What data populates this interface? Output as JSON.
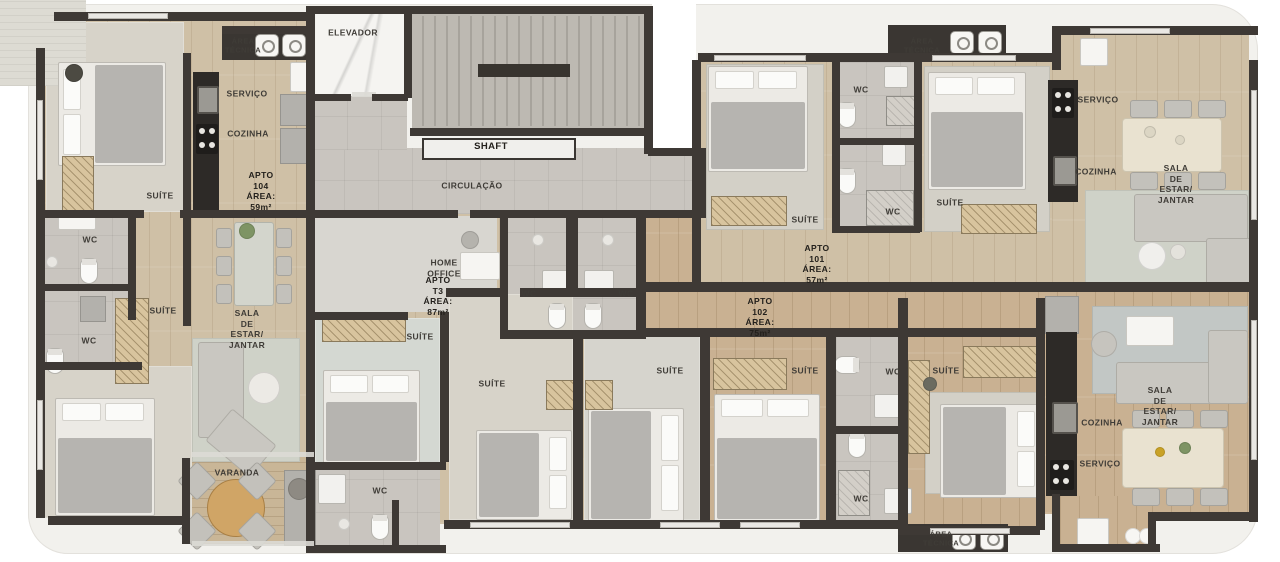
{
  "plan": {
    "title_visible": false,
    "building_common_areas": [
      "ELEVADOR",
      "SHAFT",
      "CIRCULAÇÃO",
      "ÁREA TÉCNICA"
    ],
    "apartments": [
      {
        "name": "APTO 104",
        "area": "ÁREA: 59m²",
        "rooms": [
          "SUÍTE",
          "WC",
          "SUÍTE",
          "COZINHA",
          "SERVIÇO",
          "SALA DE ESTAR/ JANTAR",
          "VARANDA",
          "WC"
        ]
      },
      {
        "name": "APTO T3",
        "area": "ÁREA: 87m²",
        "rooms": [
          "HOME OFFICE",
          "SUÍTE",
          "SUÍTE",
          "WC",
          "WC",
          "WC"
        ]
      },
      {
        "name": "APTO 101",
        "area": "ÁREA: 57m²",
        "rooms": [
          "SUÍTE",
          "SUÍTE",
          "WC",
          "WC",
          "COZINHA",
          "SERVIÇO",
          "SALA DE ESTAR/ JANTAR"
        ]
      },
      {
        "name": "APTO 102",
        "area": "ÁREA: 75m²",
        "rooms": [
          "SUÍTE",
          "SUÍTE",
          "SUÍTE",
          "WC",
          "WC",
          "COZINHA",
          "SERVIÇO",
          "SALA DE ESTAR/ JANTAR"
        ]
      }
    ]
  },
  "labels": [
    {
      "t": "ÁREA\nTÉCNICA",
      "x": 243,
      "y": 46,
      "s": 7.5,
      "b": 0
    },
    {
      "t": "ELEVADOR",
      "x": 353,
      "y": 33,
      "s": 8.5,
      "b": 0
    },
    {
      "t": "SERVIÇO",
      "x": 247,
      "y": 94,
      "s": 8.5,
      "b": 0
    },
    {
      "t": "COZINHA",
      "x": 248,
      "y": 134,
      "s": 8.5,
      "b": 0
    },
    {
      "t": "APTO 104\nÁREA: 59m²",
      "x": 261,
      "y": 191,
      "s": 8.5,
      "b": 1
    },
    {
      "t": "SUÍTE",
      "x": 160,
      "y": 196,
      "s": 8.5,
      "b": 0
    },
    {
      "t": "WC",
      "x": 90,
      "y": 240,
      "s": 8.5,
      "b": 0
    },
    {
      "t": "SUÍTE",
      "x": 163,
      "y": 311,
      "s": 8.5,
      "b": 0
    },
    {
      "t": "SALA DE ESTAR/\nJANTAR",
      "x": 247,
      "y": 329,
      "s": 8.5,
      "b": 0
    },
    {
      "t": "WC",
      "x": 89,
      "y": 341,
      "s": 8.5,
      "b": 0
    },
    {
      "t": "VARANDA",
      "x": 237,
      "y": 473,
      "s": 8.5,
      "b": 0
    },
    {
      "t": "SHAFT",
      "x": 491,
      "y": 147,
      "s": 9.5,
      "b": 1
    },
    {
      "t": "CIRCULAÇÃO",
      "x": 472,
      "y": 186,
      "s": 8.5,
      "b": 0
    },
    {
      "t": "HOME\nOFFICE",
      "x": 444,
      "y": 268,
      "s": 8.5,
      "b": 0
    },
    {
      "t": "APTO T3\nÁREA: 87m²",
      "x": 438,
      "y": 296,
      "s": 8.5,
      "b": 1
    },
    {
      "t": "SUÍTE",
      "x": 420,
      "y": 337,
      "s": 8.5,
      "b": 0
    },
    {
      "t": "WC",
      "x": 529,
      "y": 294,
      "s": 8.5,
      "b": 0
    },
    {
      "t": "WC",
      "x": 626,
      "y": 294,
      "s": 8.5,
      "b": 0
    },
    {
      "t": "SUÍTE",
      "x": 492,
      "y": 384,
      "s": 8.5,
      "b": 0
    },
    {
      "t": "WC",
      "x": 380,
      "y": 491,
      "s": 8.5,
      "b": 0
    },
    {
      "t": "ÁREA\nTÉCNICA",
      "x": 922,
      "y": 46,
      "s": 7.5,
      "b": 0
    },
    {
      "t": "WC",
      "x": 861,
      "y": 90,
      "s": 8.5,
      "b": 0
    },
    {
      "t": "SUÍTE",
      "x": 805,
      "y": 220,
      "s": 8.5,
      "b": 0
    },
    {
      "t": "WC",
      "x": 893,
      "y": 212,
      "s": 8.5,
      "b": 0
    },
    {
      "t": "SUÍTE",
      "x": 950,
      "y": 203,
      "s": 8.5,
      "b": 0
    },
    {
      "t": "APTO 101\nÁREA: 57m²",
      "x": 817,
      "y": 264,
      "s": 8.5,
      "b": 1
    },
    {
      "t": "SERVIÇO",
      "x": 1098,
      "y": 100,
      "s": 8.5,
      "b": 0
    },
    {
      "t": "COZINHA",
      "x": 1096,
      "y": 172,
      "s": 8.5,
      "b": 0
    },
    {
      "t": "SALA DE ESTAR/ JANTAR",
      "x": 1176,
      "y": 184,
      "s": 8.5,
      "b": 0
    },
    {
      "t": "APTO 102\nÁREA: 75m²",
      "x": 760,
      "y": 317,
      "s": 8.5,
      "b": 1
    },
    {
      "t": "SUÍTE",
      "x": 670,
      "y": 371,
      "s": 8.5,
      "b": 0
    },
    {
      "t": "SUÍTE",
      "x": 805,
      "y": 371,
      "s": 8.5,
      "b": 0
    },
    {
      "t": "WC",
      "x": 893,
      "y": 372,
      "s": 8.5,
      "b": 0
    },
    {
      "t": "SUÍTE",
      "x": 946,
      "y": 371,
      "s": 8.5,
      "b": 0
    },
    {
      "t": "WC",
      "x": 861,
      "y": 499,
      "s": 8.5,
      "b": 0
    },
    {
      "t": "SALA DE ESTAR/ JANTAR",
      "x": 1160,
      "y": 406,
      "s": 8.5,
      "b": 0
    },
    {
      "t": "COZINHA",
      "x": 1102,
      "y": 423,
      "s": 8.5,
      "b": 0
    },
    {
      "t": "SERVIÇO",
      "x": 1100,
      "y": 464,
      "s": 8.5,
      "b": 0
    },
    {
      "t": "ÁREA\nTÉCNICA",
      "x": 941,
      "y": 539,
      "s": 7.5,
      "b": 0
    }
  ],
  "colors": {
    "wall": "#3e3935",
    "slab": "#f2f1ed",
    "wood_light": "#cfc0a6",
    "wood_medium": "#c9b192",
    "tile": "#c9c5bf",
    "label_text": "#3f3c37",
    "label_text_bold": "#23201c"
  }
}
